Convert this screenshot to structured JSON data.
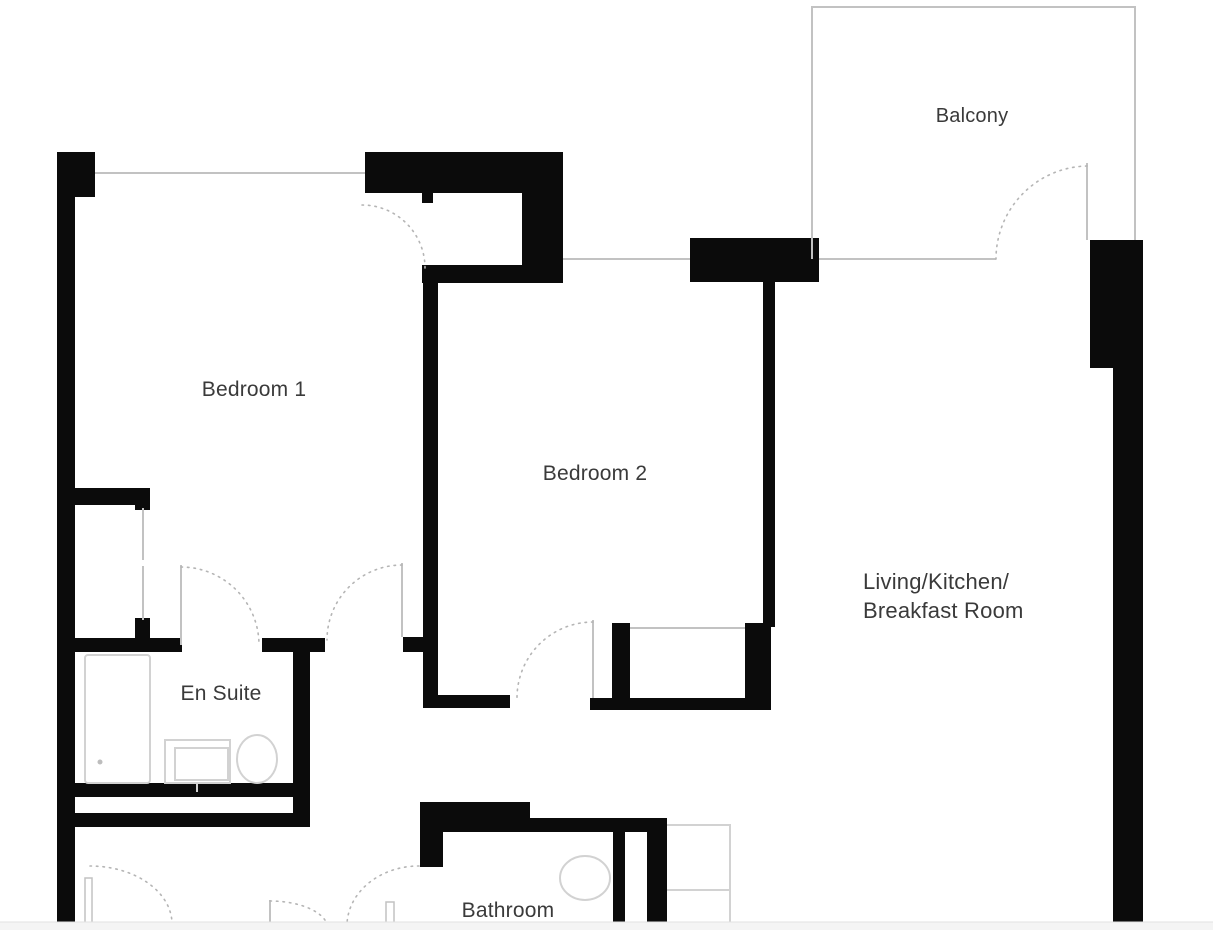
{
  "floorplan": {
    "title": "Two bedroom apartment floor plan",
    "labels": {
      "balcony": "Balcony",
      "bedroom1": "Bedroom 1",
      "bedroom2": "Bedroom 2",
      "living_line1": "Living/Kitchen/",
      "living_line2": "Breakfast Room",
      "ensuite": "En Suite",
      "bathroom": "Bathroom"
    },
    "colors": {
      "wall": "#0b0b0b",
      "window_line": "#c2c2c2",
      "fixture_line": "#d2d2d2",
      "door_arc": "#b5b5b5",
      "label_text": "#3a3a3a",
      "background": "#ffffff",
      "footer_bg": "#f4f4f4",
      "footer_border": "#e2e2e2"
    }
  }
}
